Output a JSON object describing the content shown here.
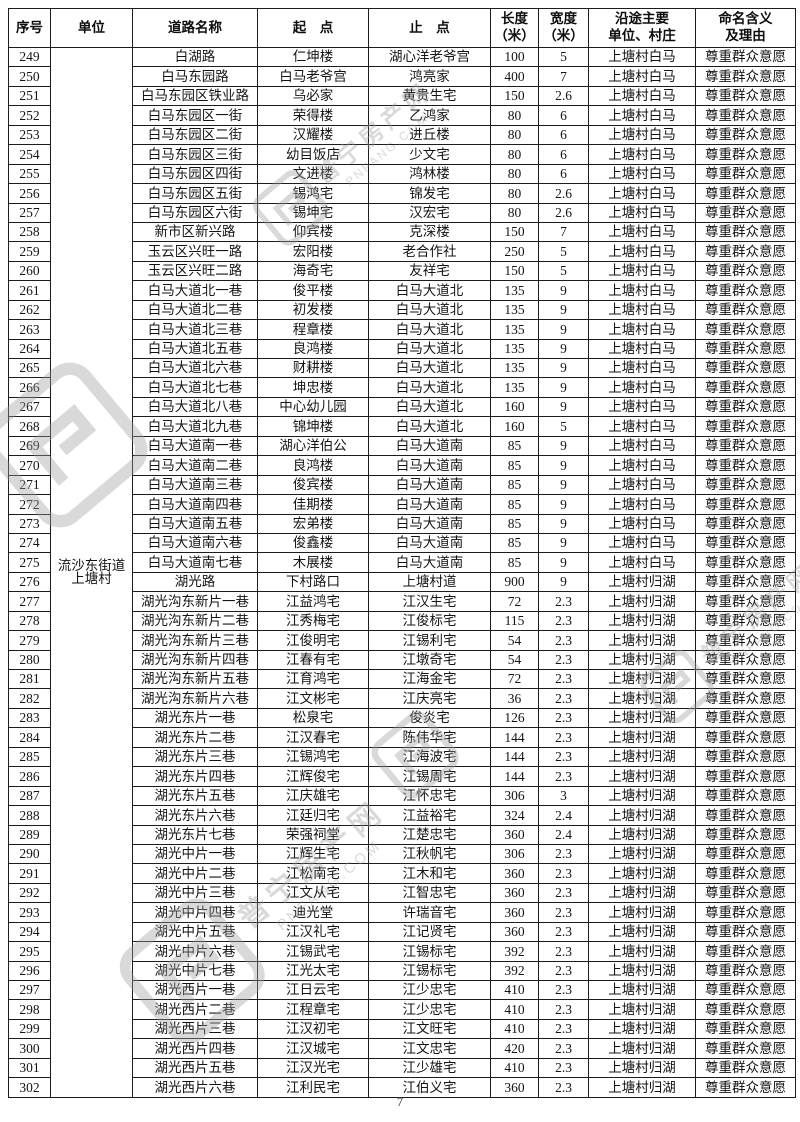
{
  "page": {
    "number": "7"
  },
  "watermark": {
    "brand": "普宁房产网",
    "domain": "PNFANG.COM"
  },
  "table": {
    "columns": [
      {
        "key": "no",
        "label": "序号"
      },
      {
        "key": "unit",
        "label": "单位"
      },
      {
        "key": "road",
        "label": "道路名称"
      },
      {
        "key": "start",
        "label": "起　点"
      },
      {
        "key": "end",
        "label": "止　点"
      },
      {
        "key": "len",
        "label": "长度\n（米）"
      },
      {
        "key": "w",
        "label": "宽度\n（米）"
      },
      {
        "key": "area",
        "label": "沿途主要\n单位、村庄"
      },
      {
        "key": "reason",
        "label": "命名含义\n及理由"
      }
    ],
    "unit": {
      "line1": "流沙东街道",
      "line2": "上塘村"
    },
    "rows": [
      {
        "no": "249",
        "road": "白湖路",
        "start": "仁坤楼",
        "end": "湖心洋老爷宫",
        "len": "100",
        "w": "5",
        "area": "上塘村白马",
        "reason": "尊重群众意愿"
      },
      {
        "no": "250",
        "road": "白马东园路",
        "start": "白马老爷宫",
        "end": "鸿亮家",
        "len": "400",
        "w": "7",
        "area": "上塘村白马",
        "reason": "尊重群众意愿"
      },
      {
        "no": "251",
        "road": "白马东园区铁业路",
        "start": "乌必家",
        "end": "黄贵生宅",
        "len": "150",
        "w": "2.6",
        "area": "上塘村白马",
        "reason": "尊重群众意愿"
      },
      {
        "no": "252",
        "road": "白马东园区一街",
        "start": "荣得楼",
        "end": "乙鸿家",
        "len": "80",
        "w": "6",
        "area": "上塘村白马",
        "reason": "尊重群众意愿"
      },
      {
        "no": "253",
        "road": "白马东园区二街",
        "start": "汉耀楼",
        "end": "进丘楼",
        "len": "80",
        "w": "6",
        "area": "上塘村白马",
        "reason": "尊重群众意愿"
      },
      {
        "no": "254",
        "road": "白马东园区三街",
        "start": "幼目饭店",
        "end": "少文宅",
        "len": "80",
        "w": "6",
        "area": "上塘村白马",
        "reason": "尊重群众意愿"
      },
      {
        "no": "255",
        "road": "白马东园区四街",
        "start": "文进楼",
        "end": "鸿林楼",
        "len": "80",
        "w": "6",
        "area": "上塘村白马",
        "reason": "尊重群众意愿"
      },
      {
        "no": "256",
        "road": "白马东园区五街",
        "start": "锡鸿宅",
        "end": "锦发宅",
        "len": "80",
        "w": "2.6",
        "area": "上塘村白马",
        "reason": "尊重群众意愿"
      },
      {
        "no": "257",
        "road": "白马东园区六街",
        "start": "锡坤宅",
        "end": "汉宏宅",
        "len": "80",
        "w": "2.6",
        "area": "上塘村白马",
        "reason": "尊重群众意愿"
      },
      {
        "no": "258",
        "road": "新市区新兴路",
        "start": "仰宾楼",
        "end": "克深楼",
        "len": "150",
        "w": "7",
        "area": "上塘村白马",
        "reason": "尊重群众意愿"
      },
      {
        "no": "259",
        "road": "玉云区兴旺一路",
        "start": "宏阳楼",
        "end": "老合作社",
        "len": "250",
        "w": "5",
        "area": "上塘村白马",
        "reason": "尊重群众意愿"
      },
      {
        "no": "260",
        "road": "玉云区兴旺二路",
        "start": "海奇宅",
        "end": "友祥宅",
        "len": "150",
        "w": "5",
        "area": "上塘村白马",
        "reason": "尊重群众意愿"
      },
      {
        "no": "261",
        "road": "白马大道北一巷",
        "start": "俊平楼",
        "end": "白马大道北",
        "len": "135",
        "w": "9",
        "area": "上塘村白马",
        "reason": "尊重群众意愿"
      },
      {
        "no": "262",
        "road": "白马大道北二巷",
        "start": "初发楼",
        "end": "白马大道北",
        "len": "135",
        "w": "9",
        "area": "上塘村白马",
        "reason": "尊重群众意愿"
      },
      {
        "no": "263",
        "road": "白马大道北三巷",
        "start": "程章楼",
        "end": "白马大道北",
        "len": "135",
        "w": "9",
        "area": "上塘村白马",
        "reason": "尊重群众意愿"
      },
      {
        "no": "264",
        "road": "白马大道北五巷",
        "start": "良鸿楼",
        "end": "白马大道北",
        "len": "135",
        "w": "9",
        "area": "上塘村白马",
        "reason": "尊重群众意愿"
      },
      {
        "no": "265",
        "road": "白马大道北六巷",
        "start": "财耕楼",
        "end": "白马大道北",
        "len": "135",
        "w": "9",
        "area": "上塘村白马",
        "reason": "尊重群众意愿"
      },
      {
        "no": "266",
        "road": "白马大道北七巷",
        "start": "坤忠楼",
        "end": "白马大道北",
        "len": "135",
        "w": "9",
        "area": "上塘村白马",
        "reason": "尊重群众意愿"
      },
      {
        "no": "267",
        "road": "白马大道北八巷",
        "start": "中心幼儿园",
        "end": "白马大道北",
        "len": "160",
        "w": "9",
        "area": "上塘村白马",
        "reason": "尊重群众意愿"
      },
      {
        "no": "268",
        "road": "白马大道北九巷",
        "start": "锦坤楼",
        "end": "白马大道北",
        "len": "160",
        "w": "5",
        "area": "上塘村白马",
        "reason": "尊重群众意愿"
      },
      {
        "no": "269",
        "road": "白马大道南一巷",
        "start": "湖心洋伯公",
        "end": "白马大道南",
        "len": "85",
        "w": "9",
        "area": "上塘村白马",
        "reason": "尊重群众意愿"
      },
      {
        "no": "270",
        "road": "白马大道南二巷",
        "start": "良鸿楼",
        "end": "白马大道南",
        "len": "85",
        "w": "9",
        "area": "上塘村白马",
        "reason": "尊重群众意愿"
      },
      {
        "no": "271",
        "road": "白马大道南三巷",
        "start": "俊宾楼",
        "end": "白马大道南",
        "len": "85",
        "w": "9",
        "area": "上塘村白马",
        "reason": "尊重群众意愿"
      },
      {
        "no": "272",
        "road": "白马大道南四巷",
        "start": "佳期楼",
        "end": "白马大道南",
        "len": "85",
        "w": "9",
        "area": "上塘村白马",
        "reason": "尊重群众意愿"
      },
      {
        "no": "273",
        "road": "白马大道南五巷",
        "start": "宏弟楼",
        "end": "白马大道南",
        "len": "85",
        "w": "9",
        "area": "上塘村白马",
        "reason": "尊重群众意愿"
      },
      {
        "no": "274",
        "road": "白马大道南六巷",
        "start": "俊鑫楼",
        "end": "白马大道南",
        "len": "85",
        "w": "9",
        "area": "上塘村白马",
        "reason": "尊重群众意愿"
      },
      {
        "no": "275",
        "road": "白马大道南七巷",
        "start": "木展楼",
        "end": "白马大道南",
        "len": "85",
        "w": "9",
        "area": "上塘村白马",
        "reason": "尊重群众意愿"
      },
      {
        "no": "276",
        "road": "湖光路",
        "start": "下村路口",
        "end": "上塘村道",
        "len": "900",
        "w": "9",
        "area": "上塘村归湖",
        "reason": "尊重群众意愿"
      },
      {
        "no": "277",
        "road": "湖光沟东新片一巷",
        "start": "江益鸿宅",
        "end": "江汉生宅",
        "len": "72",
        "w": "2.3",
        "area": "上塘村归湖",
        "reason": "尊重群众意愿"
      },
      {
        "no": "278",
        "road": "湖光沟东新片二巷",
        "start": "江秀梅宅",
        "end": "江俊标宅",
        "len": "115",
        "w": "2.3",
        "area": "上塘村归湖",
        "reason": "尊重群众意愿"
      },
      {
        "no": "279",
        "road": "湖光沟东新片三巷",
        "start": "江俊明宅",
        "end": "江锡利宅",
        "len": "54",
        "w": "2.3",
        "area": "上塘村归湖",
        "reason": "尊重群众意愿"
      },
      {
        "no": "280",
        "road": "湖光沟东新片四巷",
        "start": "江春有宅",
        "end": "江墩奇宅",
        "len": "54",
        "w": "2.3",
        "area": "上塘村归湖",
        "reason": "尊重群众意愿"
      },
      {
        "no": "281",
        "road": "湖光沟东新片五巷",
        "start": "江育鸿宅",
        "end": "江海金宅",
        "len": "72",
        "w": "2.3",
        "area": "上塘村归湖",
        "reason": "尊重群众意愿"
      },
      {
        "no": "282",
        "road": "湖光沟东新片六巷",
        "start": "江文彬宅",
        "end": "江庆亮宅",
        "len": "36",
        "w": "2.3",
        "area": "上塘村归湖",
        "reason": "尊重群众意愿"
      },
      {
        "no": "283",
        "road": "湖光东片一巷",
        "start": "松泉宅",
        "end": "俊炎宅",
        "len": "126",
        "w": "2.3",
        "area": "上塘村归湖",
        "reason": "尊重群众意愿"
      },
      {
        "no": "284",
        "road": "湖光东片二巷",
        "start": "江汉春宅",
        "end": "陈伟华宅",
        "len": "144",
        "w": "2.3",
        "area": "上塘村归湖",
        "reason": "尊重群众意愿"
      },
      {
        "no": "285",
        "road": "湖光东片三巷",
        "start": "江锡鸿宅",
        "end": "江海波宅",
        "len": "144",
        "w": "2.3",
        "area": "上塘村归湖",
        "reason": "尊重群众意愿"
      },
      {
        "no": "286",
        "road": "湖光东片四巷",
        "start": "江辉俊宅",
        "end": "江锡周宅",
        "len": "144",
        "w": "2.3",
        "area": "上塘村归湖",
        "reason": "尊重群众意愿"
      },
      {
        "no": "287",
        "road": "湖光东片五巷",
        "start": "江庆雄宅",
        "end": "江怀忠宅",
        "len": "306",
        "w": "3",
        "area": "上塘村归湖",
        "reason": "尊重群众意愿"
      },
      {
        "no": "288",
        "road": "湖光东片六巷",
        "start": "江廷归宅",
        "end": "江益裕宅",
        "len": "324",
        "w": "2.4",
        "area": "上塘村归湖",
        "reason": "尊重群众意愿"
      },
      {
        "no": "289",
        "road": "湖光东片七巷",
        "start": "荣强祠堂",
        "end": "江楚忠宅",
        "len": "360",
        "w": "2.4",
        "area": "上塘村归湖",
        "reason": "尊重群众意愿"
      },
      {
        "no": "290",
        "road": "湖光中片一巷",
        "start": "江辉生宅",
        "end": "江秋帆宅",
        "len": "306",
        "w": "2.3",
        "area": "上塘村归湖",
        "reason": "尊重群众意愿"
      },
      {
        "no": "291",
        "road": "湖光中片二巷",
        "start": "江松南宅",
        "end": "江木和宅",
        "len": "360",
        "w": "2.3",
        "area": "上塘村归湖",
        "reason": "尊重群众意愿"
      },
      {
        "no": "292",
        "road": "湖光中片三巷",
        "start": "江文从宅",
        "end": "江智忠宅",
        "len": "360",
        "w": "2.3",
        "area": "上塘村归湖",
        "reason": "尊重群众意愿"
      },
      {
        "no": "293",
        "road": "湖光中片四巷",
        "start": "迪光堂",
        "end": "许瑞音宅",
        "len": "360",
        "w": "2.3",
        "area": "上塘村归湖",
        "reason": "尊重群众意愿"
      },
      {
        "no": "294",
        "road": "湖光中片五巷",
        "start": "江汉礼宅",
        "end": "江记贤宅",
        "len": "360",
        "w": "2.3",
        "area": "上塘村归湖",
        "reason": "尊重群众意愿"
      },
      {
        "no": "295",
        "road": "湖光中片六巷",
        "start": "江锡武宅",
        "end": "江锡标宅",
        "len": "392",
        "w": "2.3",
        "area": "上塘村归湖",
        "reason": "尊重群众意愿"
      },
      {
        "no": "296",
        "road": "湖光中片七巷",
        "start": "江光太宅",
        "end": "江锡标宅",
        "len": "392",
        "w": "2.3",
        "area": "上塘村归湖",
        "reason": "尊重群众意愿"
      },
      {
        "no": "297",
        "road": "湖光西片一巷",
        "start": "江日云宅",
        "end": "江少忠宅",
        "len": "410",
        "w": "2.3",
        "area": "上塘村归湖",
        "reason": "尊重群众意愿"
      },
      {
        "no": "298",
        "road": "湖光西片二巷",
        "start": "江程章宅",
        "end": "江少忠宅",
        "len": "410",
        "w": "2.3",
        "area": "上塘村归湖",
        "reason": "尊重群众意愿"
      },
      {
        "no": "299",
        "road": "湖光西片三巷",
        "start": "江汉初宅",
        "end": "江文旺宅",
        "len": "410",
        "w": "2.3",
        "area": "上塘村归湖",
        "reason": "尊重群众意愿"
      },
      {
        "no": "300",
        "road": "湖光西片四巷",
        "start": "江汉城宅",
        "end": "江文忠宅",
        "len": "420",
        "w": "2.3",
        "area": "上塘村归湖",
        "reason": "尊重群众意愿"
      },
      {
        "no": "301",
        "road": "湖光西片五巷",
        "start": "江汉光宅",
        "end": "江少雄宅",
        "len": "410",
        "w": "2.3",
        "area": "上塘村归湖",
        "reason": "尊重群众意愿"
      },
      {
        "no": "302",
        "road": "湖光西片六巷",
        "start": "江利民宅",
        "end": "江伯义宅",
        "len": "360",
        "w": "2.3",
        "area": "上塘村归湖",
        "reason": "尊重群众意愿"
      }
    ]
  }
}
